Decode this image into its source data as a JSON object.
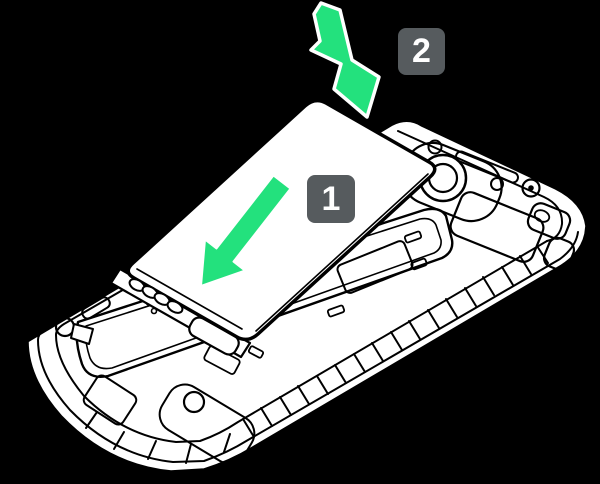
{
  "diagram": {
    "colors": {
      "background": "#000000",
      "line": "#000000",
      "surface": "#ffffff",
      "arrow_green": "#23E17D",
      "arrow_outline": "#ffffff",
      "badge_background": "#565B5E",
      "badge_text": "#FFFFFF"
    },
    "steps": [
      {
        "label": "1",
        "icon": "insert-arrow-icon"
      },
      {
        "label": "2",
        "icon": "press-arrow-icon"
      }
    ],
    "icons": [
      "insert-arrow-icon",
      "press-arrow-icon",
      "camera-lens-icon",
      "screw-icon",
      "battery-contacts"
    ]
  }
}
